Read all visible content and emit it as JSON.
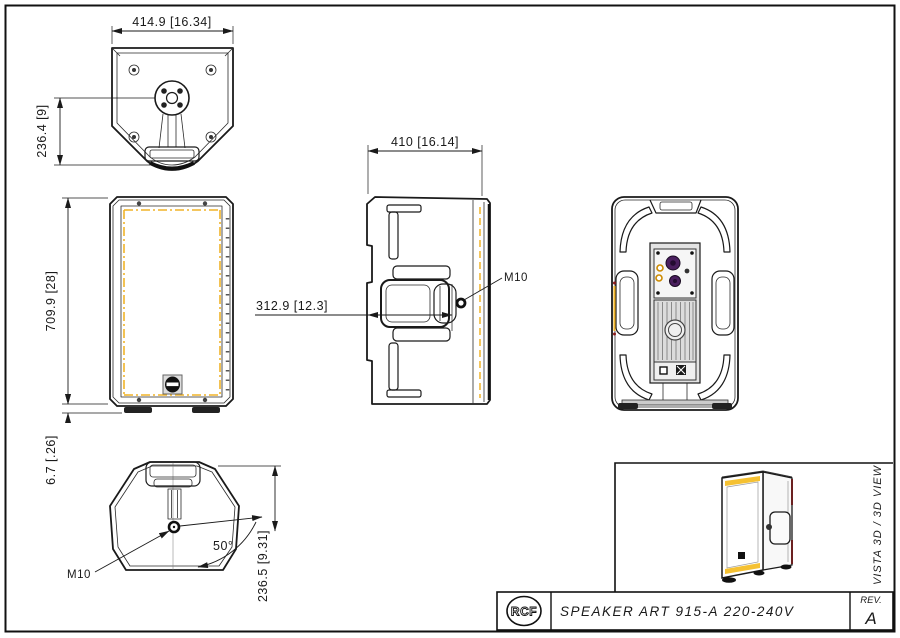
{
  "drawing": {
    "top_view": {
      "dim_width": "414.9 [16.34]",
      "dim_depth": "236.4 [9]"
    },
    "front_view": {
      "dim_height": "709.9 [28]",
      "dim_feet": "6.7 [.26]"
    },
    "side_view": {
      "dim_depth": "410 [16.14]",
      "dim_m10_offset": "312.9 [12.3]",
      "m10_label": "M10"
    },
    "bottom_view": {
      "dim_depth": "236.5 [9.31]",
      "angle": "50°",
      "m10_label": "M10"
    },
    "view3d": {
      "label": "VISTA 3D / 3D VIEW"
    },
    "title_block": {
      "logo": "RCF",
      "description": "SPEAKER ART 915-A 220-240V",
      "rev_label": "REV.",
      "rev_value": "A"
    },
    "colors": {
      "accent_yellow": "#f0b429",
      "knob_purple": "#4a1f5e",
      "line": "#1a1a1a"
    }
  }
}
